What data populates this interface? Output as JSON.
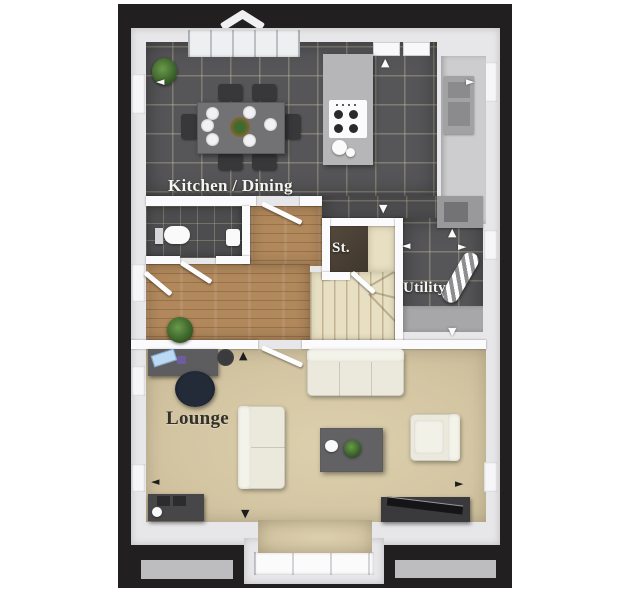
{
  "plan": {
    "type": "floor-plan",
    "labels": {
      "kitchen_dining": "Kitchen / Dining",
      "storage": "St.",
      "utility": "Utility",
      "lounge": "Lounge"
    },
    "icons": {
      "arrow_up": "▲",
      "arrow_down": "▼",
      "arrow_left": "◄",
      "arrow_right": "►"
    },
    "colors": {
      "page_background": "#ffffff",
      "outline": "#211f20",
      "exterior_wall": "#e7e7e9",
      "kitchen_tile": "#565658",
      "wc_tile": "#4d4d4f",
      "hall_wood": "#b1885c",
      "stairs_carpet": "#e8dfc2",
      "storage_floor": "#4a4139",
      "lounge_carpet": "#d6c9a6",
      "label_light": "#f4f4f1",
      "label_dark": "#34312b"
    },
    "furniture": [
      "dining-table-with-six-chairs",
      "island-with-hob",
      "kitchen-counter",
      "tall-appliance-unit",
      "boiler-cupboard",
      "toilet",
      "basin",
      "staircase",
      "storage-cupboard",
      "ironing-board",
      "utility-counter",
      "desk-with-laptop",
      "office-chair",
      "waste-bin",
      "three-seat-sofa",
      "two-seat-sofa",
      "coffee-table-with-plant",
      "teapot",
      "armchair",
      "tv-unit",
      "sideboard",
      "potted-plants",
      "bay-window"
    ]
  }
}
